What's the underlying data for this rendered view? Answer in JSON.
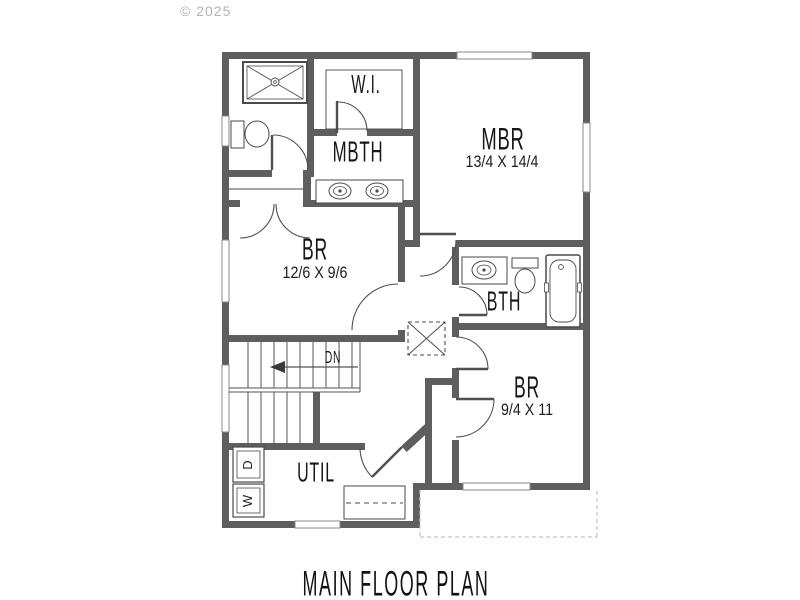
{
  "watermark": "© 2025",
  "title": "MAIN FLOOR PLAN",
  "rooms": {
    "walk_in_closet": {
      "label": "W.I."
    },
    "master_bath": {
      "label": "MBTH"
    },
    "master_bedroom": {
      "label": "MBR",
      "dimensions": "13/4 X 14/4"
    },
    "bedroom_2": {
      "label": "BR",
      "dimensions": "12/6 X 9/6"
    },
    "bath": {
      "label": "BTH"
    },
    "bedroom_3": {
      "label": "BR",
      "dimensions": "9/4 X 11"
    },
    "utility": {
      "label": "UTIL"
    }
  },
  "stairs": {
    "direction_label": "DN"
  },
  "appliances": {
    "dryer_label": "D",
    "washer_label": "W"
  },
  "colors": {
    "wall": "#5e5e5e",
    "line": "#4f4f4f",
    "watermark_text": "#b4b4b4",
    "porch_dashed": "#c4c4c4"
  }
}
